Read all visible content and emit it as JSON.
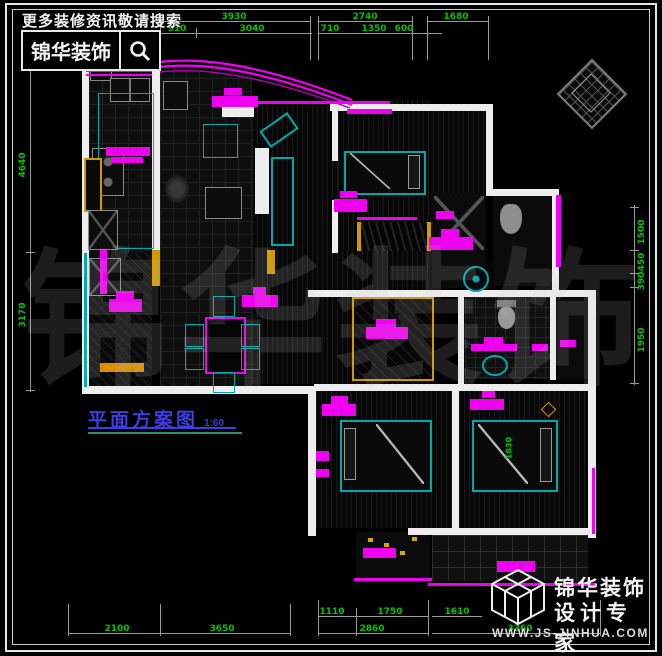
{
  "header": {
    "tagline": "更多装修资讯敬请搜索",
    "brand": "锦华装饰",
    "search_icon": "magnifier"
  },
  "title_label": {
    "text": "平面方案图",
    "scale": "1:60"
  },
  "watermark": {
    "chars": [
      "锦",
      "华",
      "装",
      "饰"
    ]
  },
  "logo": {
    "brand": "锦华装饰",
    "subtitle": "设计专家",
    "website": "WWW.JS-JINHUA.COM",
    "cube_icon": "wireframe-cube"
  },
  "ornament": {
    "icon": "diamond-compass-stamp"
  },
  "dimensions": {
    "top_row1": [
      "3930",
      "2740",
      "1680"
    ],
    "top_row2": [
      "910",
      "3040",
      "710",
      "1350",
      "600"
    ],
    "left": [
      "4640",
      "3170"
    ],
    "right": [
      "1500",
      "450",
      "390",
      "1950"
    ],
    "bottom_row1": [
      "1110",
      "1750",
      "1610"
    ],
    "bottom_row2": [
      "2100",
      "3650",
      "2860",
      "3360"
    ],
    "interior": [
      "1830"
    ]
  },
  "colors": {
    "highlight_magenta": "#f000f0",
    "furniture_teal": "#00a8a8",
    "dimension_green": "#00c400",
    "label_blue": "#3d3de0",
    "wall_white": "#ededed",
    "door_yellow": "#cf9a00"
  }
}
